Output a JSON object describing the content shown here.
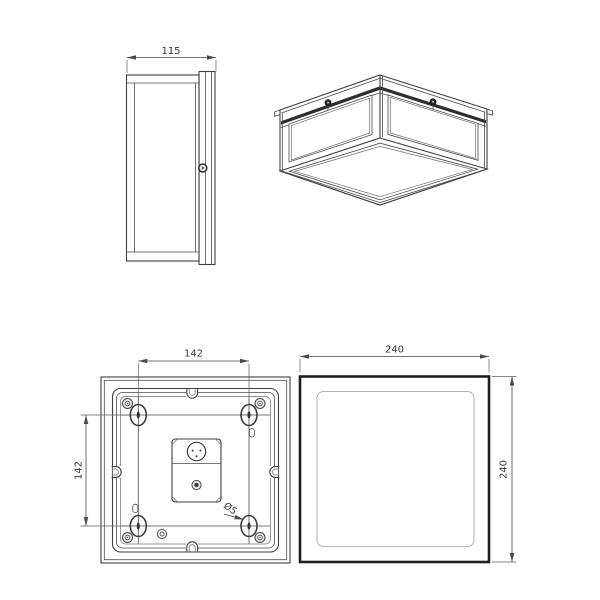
{
  "colors": {
    "background": "#ffffff",
    "line": "#3f3f3f",
    "line_heavy": "#1f1f1f",
    "line_light": "#9c9c9c",
    "dimension_line": "#4a4a4a",
    "top_rail_band": "#2e2e2e",
    "text": "#3a3a3a"
  },
  "dimensions": {
    "side_width_mm": "115",
    "mount_spacing_horizontal_mm": "142",
    "mount_spacing_vertical_mm": "142",
    "mount_hole_diameter": "Ø5",
    "front_width_mm": "240",
    "front_height_mm": "240"
  }
}
